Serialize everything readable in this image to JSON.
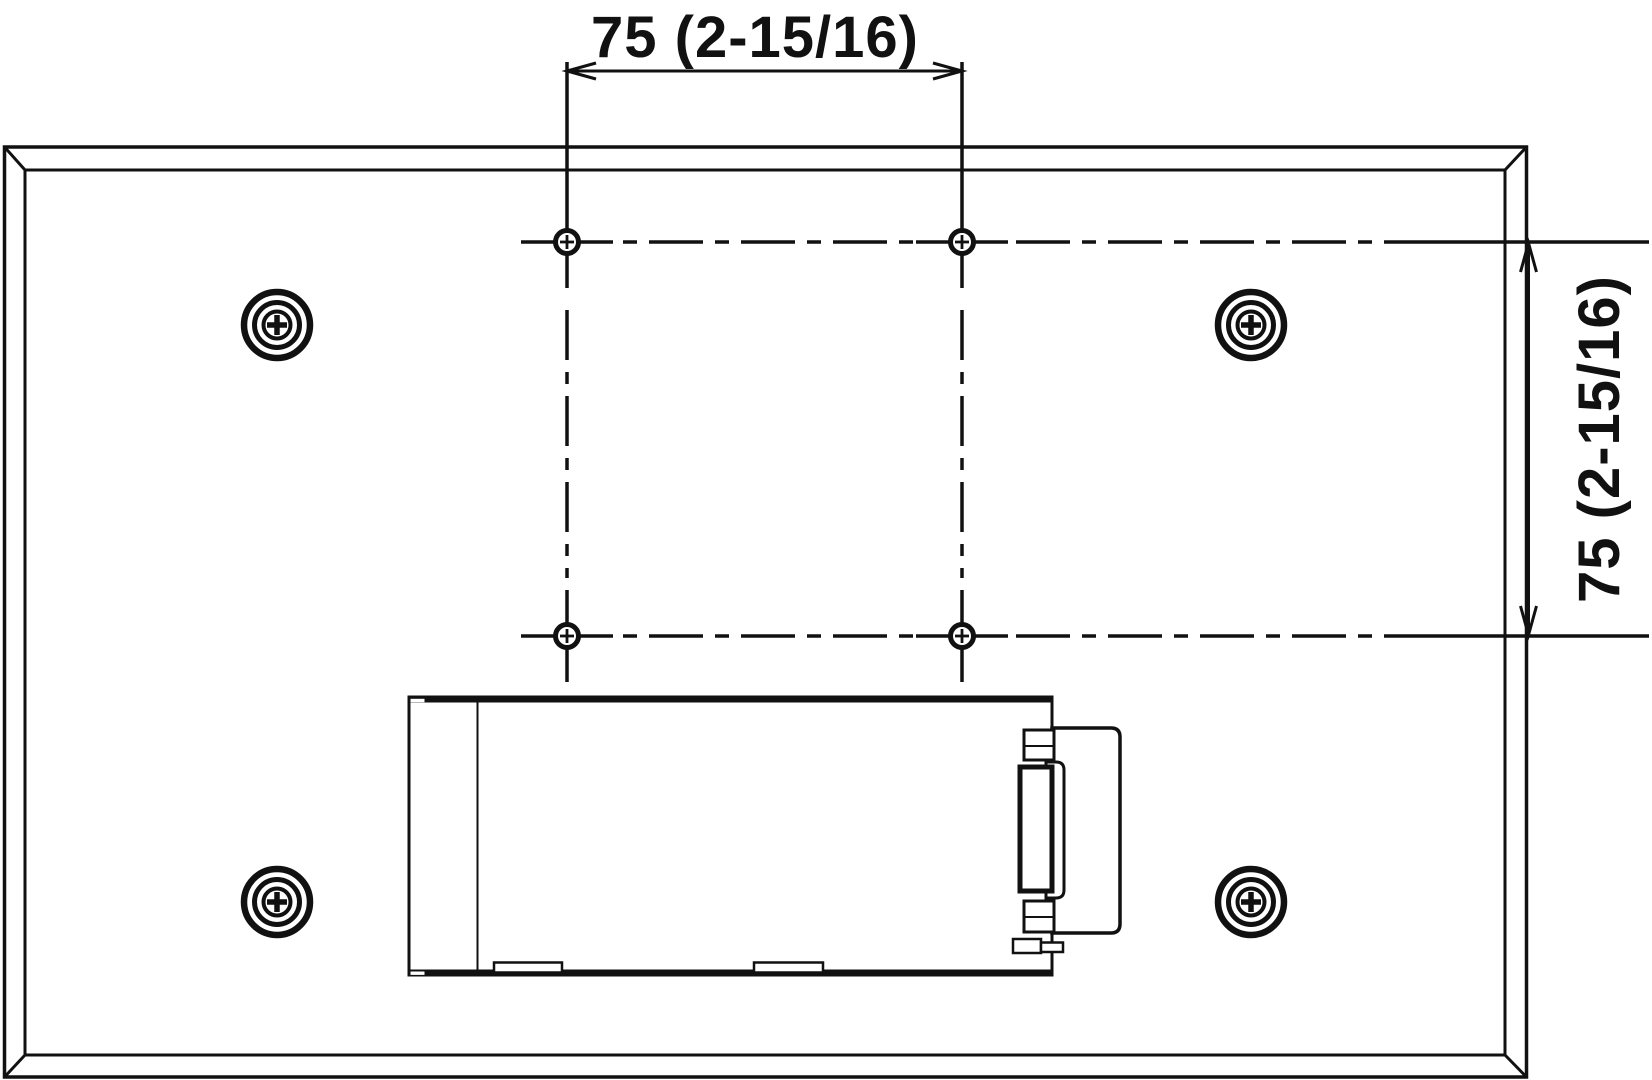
{
  "drawing": {
    "kind": "rear-panel-mounting-diagram",
    "dimension_labels": {
      "horizontal": "75 (2-15/16)",
      "vertical": "75 (2-15/16)"
    },
    "symbols": {
      "vesa_hole_count": 4,
      "corner_screw_count": 4
    },
    "colors": {
      "line": "#111111",
      "background": "#ffffff"
    }
  }
}
